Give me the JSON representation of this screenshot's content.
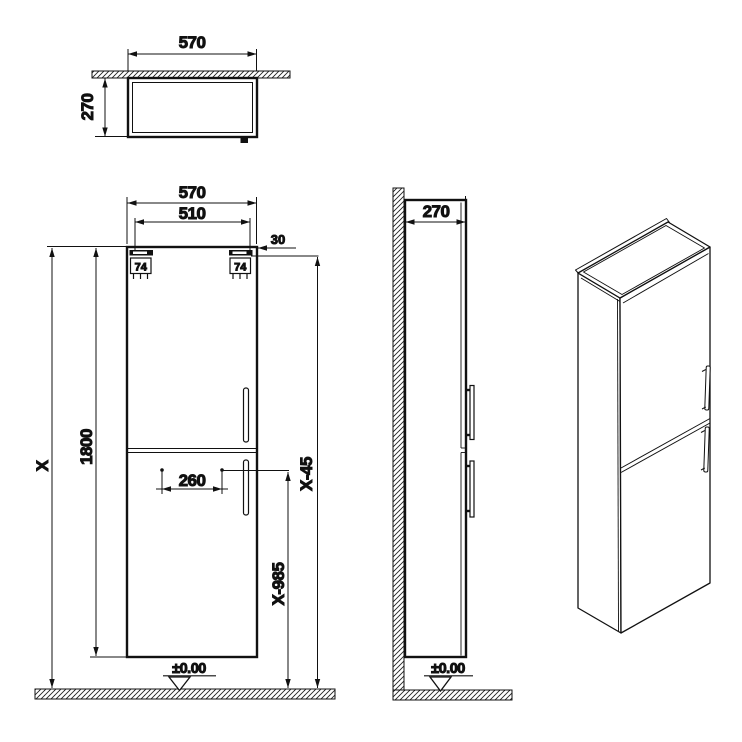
{
  "top_view": {
    "width": "570",
    "depth": "270"
  },
  "front_view": {
    "width": "570",
    "inner_width": "510",
    "edge_offset": "30",
    "bracket_left": "74",
    "bracket_right": "74",
    "overall_height": "X",
    "cabinet_height": "1800",
    "handle_spacing": "260",
    "upper_handle_height": "X-45",
    "lower_handle_height": "X-985",
    "floor_level": "±0.00"
  },
  "side_view": {
    "depth": "270",
    "floor_level": "±0.00"
  },
  "colors": {
    "line": "#111111",
    "background": "#ffffff"
  }
}
